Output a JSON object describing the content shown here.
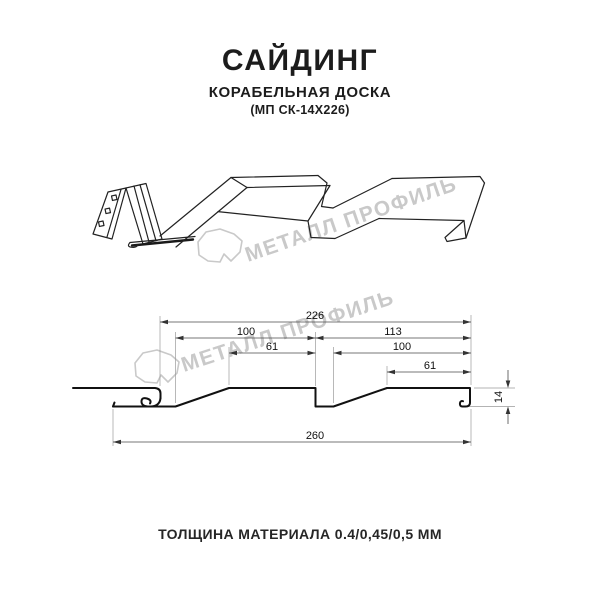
{
  "header": {
    "title": "САЙДИНГ",
    "subtitle": "КОРАБЕЛЬНАЯ ДОСКА",
    "model_code": "(МП СК-14Х226)"
  },
  "watermark": {
    "brand_text": "МЕТАЛЛ ПРОФИЛЬ",
    "color": "#c9c9c9"
  },
  "section_drawing": {
    "dimensions": {
      "d226": "226",
      "d100_left": "100",
      "d61_left": "61",
      "d113": "113",
      "d100_right": "100",
      "d61_right": "61",
      "d260": "260",
      "d14": "14"
    }
  },
  "footer": {
    "thickness_note": "ТОЛЩИНА МАТЕРИАЛА 0.4/0,45/0,5 ММ"
  },
  "colors": {
    "ink": "#1c1c1c",
    "watermark_gray": "#c9c9c9"
  }
}
